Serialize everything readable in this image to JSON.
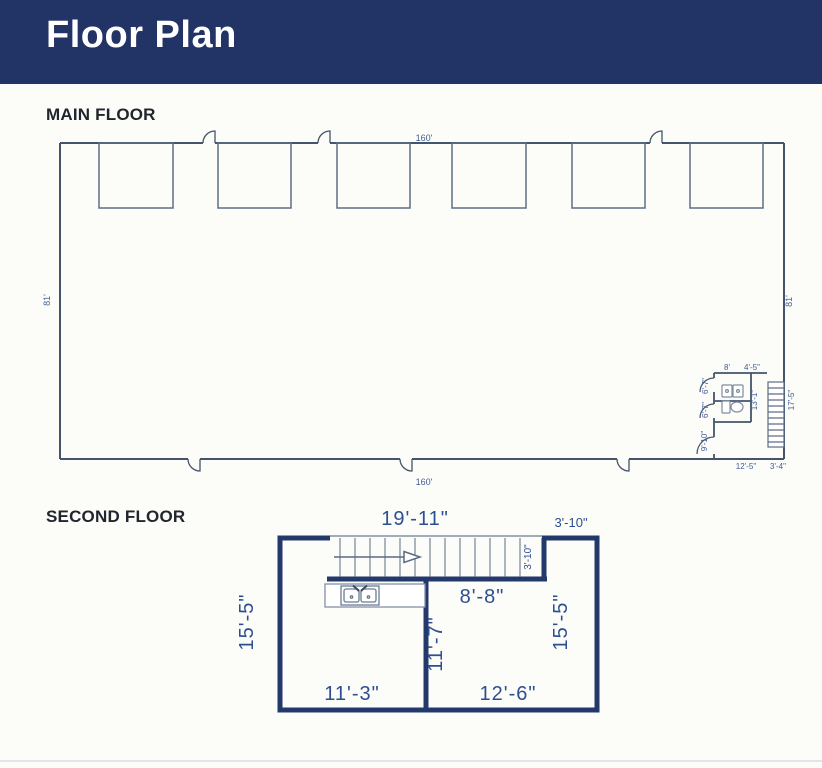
{
  "header": {
    "title": "Floor Plan"
  },
  "colors": {
    "header_bg": "#223365",
    "wall_thin": "#44546a",
    "wall_thick": "#24396b",
    "dim_text_small": "#3f5c99",
    "dim_text_large": "#2d4f91"
  },
  "main_floor": {
    "heading": "MAIN FLOOR",
    "dims": {
      "top_width": "160'",
      "bottom_width": "160'",
      "left_height": "81'",
      "right_height": "81'",
      "bath_width": "8'",
      "bath_closet_width": "4'-5\"",
      "stall1_depth": "6'-7\"",
      "stall2_depth": "6'-7\"",
      "room_depth": "9'-10\"",
      "bath_length": "13'-1\"",
      "stair_length": "17'-5\"",
      "bath_bottom_width": "12'-5\"",
      "stair_bottom_width": "3'-4\""
    }
  },
  "second_floor": {
    "heading": "SECOND FLOOR",
    "dims": {
      "stair_width": "19'-11\"",
      "landing_width": "3'-10\"",
      "landing_depth": "3'-10\"",
      "hall_width": "8'-8\"",
      "left_height": "15'-5\"",
      "right_height": "15'-5\"",
      "interior_wall_height": "11'-7\"",
      "left_room_width": "11'-3\"",
      "right_room_width": "12'-6\""
    }
  }
}
